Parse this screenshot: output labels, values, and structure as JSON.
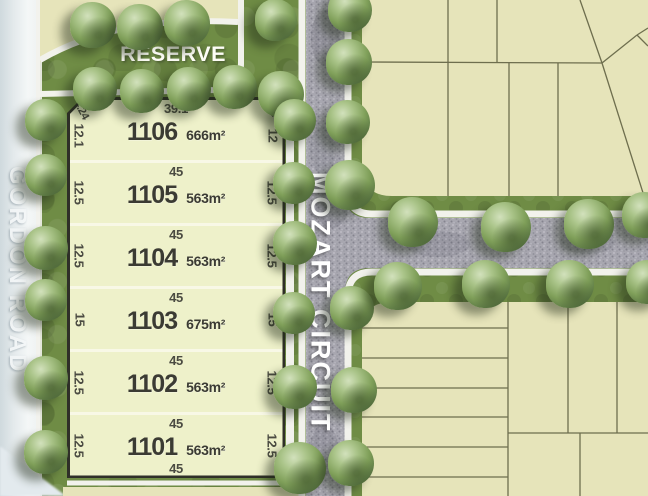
{
  "labels": {
    "reserve": "RESERVE"
  },
  "streets": {
    "vertical": "MOZART CIRCUIT",
    "left": "GORDON ROAD"
  },
  "lots": [
    {
      "number": "1106",
      "area": "666m²",
      "top": "39.1",
      "left": "12.1",
      "right": "12",
      "corner_left": "4.24",
      "corner_right": "4.24",
      "bottom": ""
    },
    {
      "number": "1105",
      "area": "563m²",
      "top": "45",
      "left": "12.5",
      "right": "12.5",
      "corner_left": "",
      "corner_right": "",
      "bottom": ""
    },
    {
      "number": "1104",
      "area": "563m²",
      "top": "45",
      "left": "12.5",
      "right": "12.5",
      "corner_left": "",
      "corner_right": "",
      "bottom": ""
    },
    {
      "number": "1103",
      "area": "675m²",
      "top": "45",
      "left": "15",
      "right": "15",
      "corner_left": "",
      "corner_right": "",
      "bottom": ""
    },
    {
      "number": "1102",
      "area": "563m²",
      "top": "45",
      "left": "12.5",
      "right": "12.5",
      "corner_left": "",
      "corner_right": "",
      "bottom": ""
    },
    {
      "number": "1101",
      "area": "563m²",
      "top": "45",
      "left": "12.5",
      "right": "12.5",
      "corner_left": "",
      "corner_right": "",
      "bottom": "45"
    }
  ],
  "colors": {
    "lot_fill": "#eef1ca",
    "lot_border": "#2f2f28",
    "parcel_tan": "#e6e4ba",
    "parcel_line": "#6e6e4e",
    "grass": "#6f8c45",
    "road": "#a8a7b0",
    "sidewalk": "#f2f2ec",
    "dim_text": "#4b4b42"
  },
  "trees": [
    {
      "x": 93,
      "y": 25,
      "d": 46
    },
    {
      "x": 140,
      "y": 27,
      "d": 46
    },
    {
      "x": 187,
      "y": 23,
      "d": 46
    },
    {
      "x": 276,
      "y": 20,
      "d": 42
    },
    {
      "x": 95,
      "y": 89,
      "d": 44
    },
    {
      "x": 142,
      "y": 91,
      "d": 44
    },
    {
      "x": 189,
      "y": 89,
      "d": 44
    },
    {
      "x": 235,
      "y": 87,
      "d": 44
    },
    {
      "x": 281,
      "y": 94,
      "d": 46
    },
    {
      "x": 46,
      "y": 120,
      "d": 42
    },
    {
      "x": 46,
      "y": 175,
      "d": 42
    },
    {
      "x": 46,
      "y": 248,
      "d": 44
    },
    {
      "x": 46,
      "y": 300,
      "d": 42
    },
    {
      "x": 46,
      "y": 378,
      "d": 44
    },
    {
      "x": 46,
      "y": 452,
      "d": 44
    },
    {
      "x": 295,
      "y": 120,
      "d": 42
    },
    {
      "x": 294,
      "y": 183,
      "d": 42
    },
    {
      "x": 295,
      "y": 243,
      "d": 44
    },
    {
      "x": 294,
      "y": 313,
      "d": 42
    },
    {
      "x": 295,
      "y": 387,
      "d": 44
    },
    {
      "x": 300,
      "y": 468,
      "d": 52
    },
    {
      "x": 350,
      "y": 10,
      "d": 44
    },
    {
      "x": 349,
      "y": 62,
      "d": 46
    },
    {
      "x": 348,
      "y": 122,
      "d": 44
    },
    {
      "x": 350,
      "y": 185,
      "d": 50
    },
    {
      "x": 352,
      "y": 308,
      "d": 44
    },
    {
      "x": 354,
      "y": 390,
      "d": 46
    },
    {
      "x": 351,
      "y": 463,
      "d": 46
    },
    {
      "x": 413,
      "y": 222,
      "d": 50
    },
    {
      "x": 506,
      "y": 227,
      "d": 50
    },
    {
      "x": 589,
      "y": 224,
      "d": 50
    },
    {
      "x": 645,
      "y": 215,
      "d": 46
    },
    {
      "x": 398,
      "y": 286,
      "d": 48
    },
    {
      "x": 486,
      "y": 284,
      "d": 48
    },
    {
      "x": 570,
      "y": 284,
      "d": 48
    },
    {
      "x": 648,
      "y": 282,
      "d": 44
    }
  ]
}
